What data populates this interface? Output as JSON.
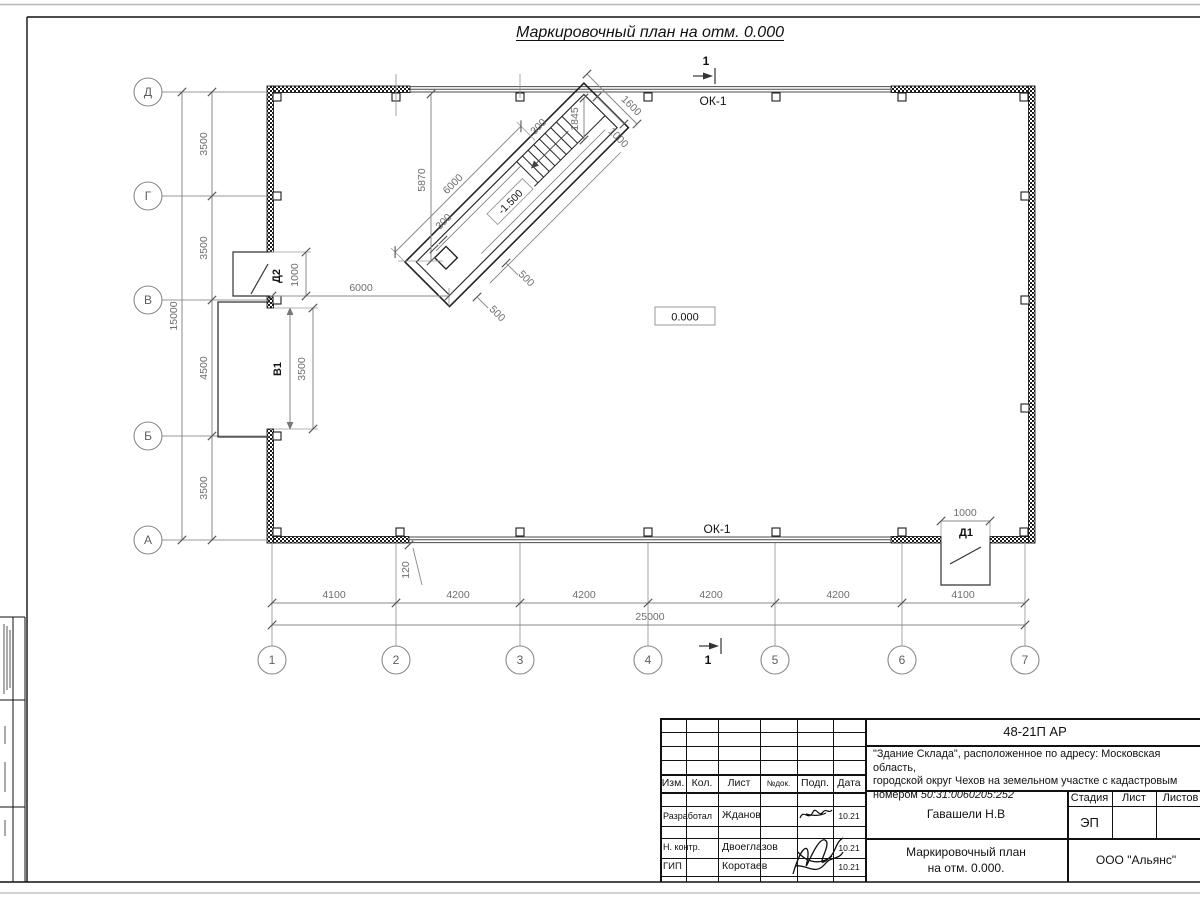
{
  "plan": {
    "title": "Маркировочный план на отм. 0.000",
    "level_zero": "0.000",
    "axes_v": [
      "Д",
      "Г",
      "В",
      "Б",
      "А"
    ],
    "axes_h": [
      "1",
      "2",
      "3",
      "4",
      "5",
      "6",
      "7"
    ],
    "dims_left": [
      "3500",
      "3500",
      "4500",
      "3500"
    ],
    "dim_left_total": "15000",
    "dims_bottom": [
      "4100",
      "4200",
      "4200",
      "4200",
      "4200",
      "4100"
    ],
    "dim_bottom_total": "25000",
    "dim_wall_offset": "120",
    "ok1": "ОК-1",
    "section": "1",
    "doors": {
      "d1": "Д1",
      "d1_dim": "1000",
      "d2": "Д2",
      "d2_dim": "1000",
      "v1": "В1",
      "v1_dim": "3500"
    },
    "ramp": {
      "level": "-1.500",
      "len": "6000",
      "to_wall": "6000",
      "drop": "5870",
      "wall_a": "300",
      "wall_b": "300",
      "stair": "1845",
      "end": "1600",
      "flight": "1000",
      "pit_a": "500",
      "pit_b": "500"
    }
  },
  "titleblock": {
    "doc_number": "48-21П АР",
    "description_l1": "\"Здание Склада\", расположенное по адресу: Московская область,",
    "description_l2": "городской округ Чехов на земельном участке с кадастровым",
    "description_l3_prefix": "номером ",
    "cadastre": "50:31:0060205:252",
    "cols": {
      "izm": "Изм.",
      "kol": "Кол.",
      "list": "Лист",
      "ndok": "№док.",
      "podp": "Подп.",
      "data": "Дата"
    },
    "rows": [
      {
        "role": "Разработал",
        "name": "Жданов",
        "date": "10.21"
      },
      {
        "role": "Н. контр.",
        "name": "Двоеглазов",
        "date": "10.21"
      },
      {
        "role": "ГИП",
        "name": "Коротаев",
        "date": "10.21"
      }
    ],
    "author": "Гавашели Н.В",
    "stage_label": "Стадия",
    "sheet_label": "Лист",
    "sheets_label": "Листов",
    "stage": "ЭП",
    "drawing_name_l1": "Маркировочный план",
    "drawing_name_l2": "на отм. 0.000.",
    "company": "ООО \"Альянс\""
  }
}
